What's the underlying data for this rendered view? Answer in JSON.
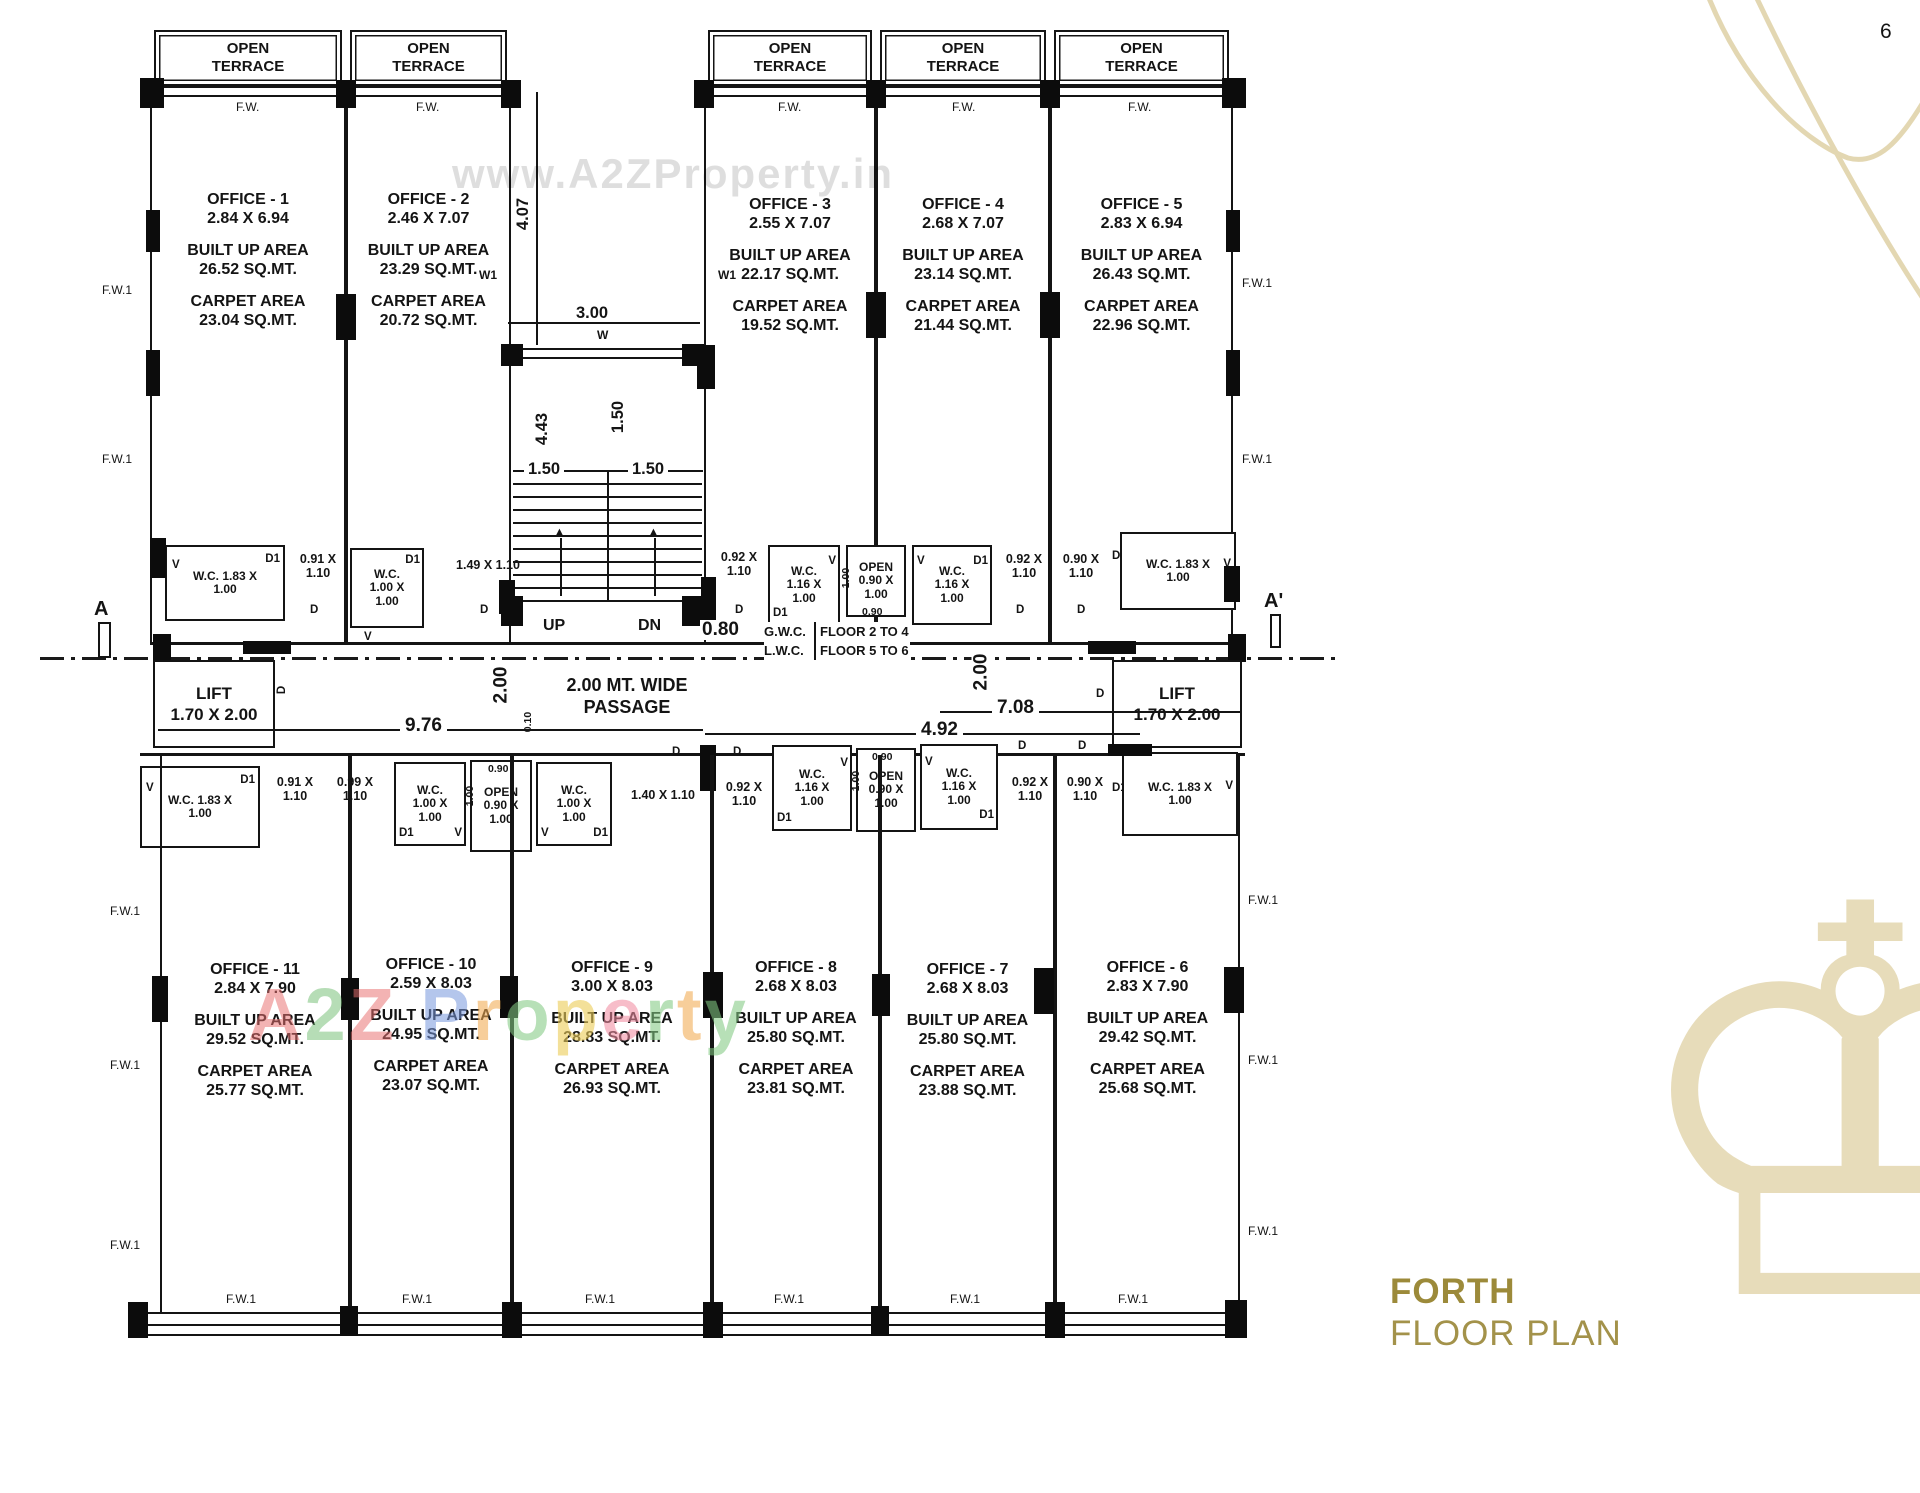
{
  "page": {
    "number": "6"
  },
  "watermarks": {
    "top": "www.A2ZProperty.in",
    "bottom_letters": [
      {
        "ch": "A",
        "style": "color:rgba(233,112,112,0.62)"
      },
      {
        "ch": "2",
        "style": "color:rgba(118,190,118,0.62)"
      },
      {
        "ch": "Z",
        "style": "color:rgba(233,112,112,0.62)"
      },
      {
        "ch": " ",
        "style": "color:transparent"
      },
      {
        "ch": "P",
        "style": "color:rgba(120,150,220,0.65)"
      },
      {
        "ch": "r",
        "style": "color:rgba(240,170,80,0.68)"
      },
      {
        "ch": "o",
        "style": "color:rgba(130,200,130,0.68)"
      },
      {
        "ch": "p",
        "style": "color:rgba(235,205,90,0.72)"
      },
      {
        "ch": "e",
        "style": "color:rgba(240,140,160,0.68)"
      },
      {
        "ch": "r",
        "style": "color:rgba(130,200,130,0.68)"
      },
      {
        "ch": "t",
        "style": "color:rgba(240,170,80,0.68)"
      },
      {
        "ch": "y",
        "style": "color:rgba(130,200,130,0.68)"
      }
    ]
  },
  "title": {
    "line1": "FORTH",
    "line2": "FLOOR PLAN"
  },
  "colors": {
    "gold": "#9c8a3a",
    "light_gold": "#e3d7b2",
    "ink": "#141414"
  },
  "labels": {
    "open_terrace": "OPEN TERRACE",
    "fw": "F.W.",
    "fw1": "F.W.1",
    "v": "V",
    "d": "D",
    "d1": "D1",
    "w": "W",
    "w1": "W1",
    "up": "UP",
    "dn": "DN",
    "a": "A",
    "a_prime": "A'"
  },
  "area_labels": {
    "built": "BUILT UP AREA",
    "carpet": "CARPET AREA"
  },
  "offices_top": [
    {
      "name": "OFFICE - 1",
      "size": "2.84 X 6.94",
      "built": "26.52 SQ.MT.",
      "carpet": "23.04 SQ.MT."
    },
    {
      "name": "OFFICE - 2",
      "size": "2.46 X 7.07",
      "built": "23.29 SQ.MT.",
      "carpet": "20.72 SQ.MT."
    },
    {
      "name": "OFFICE - 3",
      "size": "2.55 X 7.07",
      "built": "22.17 SQ.MT.",
      "carpet": "19.52 SQ.MT."
    },
    {
      "name": "OFFICE - 4",
      "size": "2.68 X 7.07",
      "built": "23.14 SQ.MT.",
      "carpet": "21.44 SQ.MT."
    },
    {
      "name": "OFFICE - 5",
      "size": "2.83 X 6.94",
      "built": "26.43 SQ.MT.",
      "carpet": "22.96 SQ.MT."
    }
  ],
  "offices_bottom": [
    {
      "name": "OFFICE - 11",
      "size": "2.84 X 7.90",
      "built": "29.52 SQ.MT.",
      "carpet": "25.77 SQ.MT."
    },
    {
      "name": "OFFICE - 10",
      "size": "2.59 X 8.03",
      "built": "24.95 SQ.MT.",
      "carpet": "23.07 SQ.MT."
    },
    {
      "name": "OFFICE - 9",
      "size": "3.00 X 8.03",
      "built": "28.83 SQ.MT.",
      "carpet": "26.93 SQ.MT."
    },
    {
      "name": "OFFICE - 8",
      "size": "2.68 X 8.03",
      "built": "25.80 SQ.MT.",
      "carpet": "23.81 SQ.MT."
    },
    {
      "name": "OFFICE - 7",
      "size": "2.68 X 8.03",
      "built": "25.80 SQ.MT.",
      "carpet": "23.88 SQ.MT."
    },
    {
      "name": "OFFICE - 6",
      "size": "2.83 X 7.90",
      "built": "29.42 SQ.MT.",
      "carpet": "25.68 SQ.MT."
    }
  ],
  "wc": {
    "wc183": "W.C. 1.83 X 1.00",
    "wc100": "W.C. 1.00 X 1.00",
    "wc116": "W.C. 1.16 X 1.00",
    "open090": "OPEN 0.90 X 1.00",
    "g091": "0.91 X 1.10",
    "g099": "0.99 X 1.10",
    "g149": "1.49 X 1.10",
    "g140": "1.40 X 1.10",
    "g092": "0.92 X 1.10",
    "g090": "0.90 X 1.10"
  },
  "lift": {
    "name": "LIFT",
    "dim": "1.70 X 2.00"
  },
  "passage": {
    "label": "2.00 MT. WIDE PASSAGE"
  },
  "gwc": {
    "r1c1": "G.W.C.",
    "r1c2": "FLOOR 2 TO 4",
    "r2c1": "L.W.C.",
    "r2c2": "FLOOR 5 TO 6"
  },
  "dims": {
    "d407": "4.07",
    "d300": "3.00",
    "d443": "4.43",
    "d150": "1.50",
    "d080": "0.80",
    "d200": "2.00",
    "d976": "9.76",
    "d708": "7.08",
    "d492": "4.92",
    "d010": "0.10",
    "d090": "0.90",
    "d100": "1.00"
  }
}
